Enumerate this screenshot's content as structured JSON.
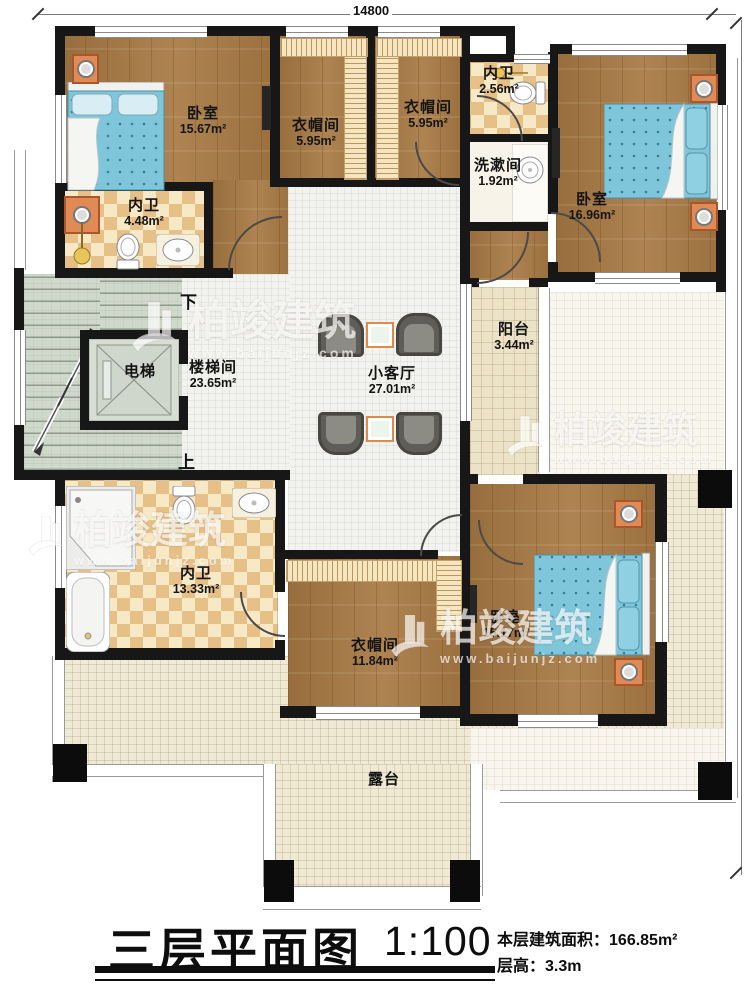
{
  "dimensions": {
    "top_width": "14800",
    "right_height": "17300"
  },
  "stairs": {
    "down": "下",
    "up": "上"
  },
  "rooms": {
    "bedroom_tl": {
      "name": "卧室",
      "area": "15.67m²"
    },
    "bath_tl": {
      "name": "内卫",
      "area": "4.48m²"
    },
    "closet_1": {
      "name": "衣帽间",
      "area": "5.95m²"
    },
    "closet_2": {
      "name": "衣帽间",
      "area": "5.95m²"
    },
    "bath_tr": {
      "name": "内卫",
      "area": "2.56m²"
    },
    "washroom": {
      "name": "洗漱间",
      "area": "1.92m²"
    },
    "bedroom_tr": {
      "name": "卧室",
      "area": "16.96m²"
    },
    "stairwell": {
      "name": "楼梯间",
      "area": "23.65m²"
    },
    "elevator": {
      "name": "电梯"
    },
    "lounge": {
      "name": "小客厅",
      "area": "27.01m²"
    },
    "balcony": {
      "name": "阳台",
      "area": "3.44m²"
    },
    "bath_bl": {
      "name": "内卫",
      "area": "13.33m²"
    },
    "closet_3": {
      "name": "衣帽间",
      "area": "11.84m²"
    },
    "bedroom_br": {
      "name": "卧室",
      "area": "15.17m²"
    },
    "terrace": {
      "name": "露台"
    }
  },
  "watermark": {
    "brand": "柏竣建筑",
    "url": "www.baijunjz.com"
  },
  "title_block": {
    "title": "三层平面图",
    "scale": "1:100",
    "area_label": "本层建筑面积：",
    "area_value": "166.85m²",
    "floor_height_label": "层高：",
    "floor_height_value": "3.3m"
  },
  "colors": {
    "wall": "#171717",
    "wood": "#a87a44",
    "tile": "#efe9d5",
    "bed": "#7fc6da",
    "accent_orange": "#e08a55"
  }
}
